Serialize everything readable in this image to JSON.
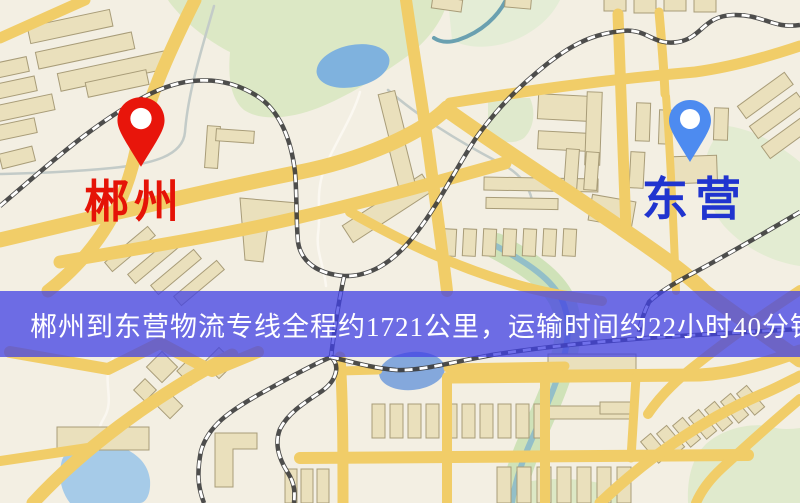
{
  "markers": {
    "origin": {
      "label": "郴州",
      "pin_color": "#e8150b",
      "label_color": "#e51307",
      "icon": "red-location-pin-icon"
    },
    "destination": {
      "label": "东营",
      "pin_color": "#4d8bf0",
      "label_color": "#2034cf",
      "icon": "blue-location-pin-icon"
    }
  },
  "banner": {
    "text": "郴州到东营物流专线全程约1721公里，运输时间约22小时40分钟.",
    "background_color": "rgba(64,64,228,0.75)",
    "text_color": "#ffffff"
  },
  "route": {
    "origin": "郴州",
    "destination": "东营",
    "distance": "约1721公里",
    "duration": "约22小时40分钟"
  },
  "map_colors": {
    "background": "#f3efe3",
    "road": "#f1cd68",
    "park": "#dce8c5",
    "water": "#7fb2de",
    "railway": "#3b3b3b"
  }
}
